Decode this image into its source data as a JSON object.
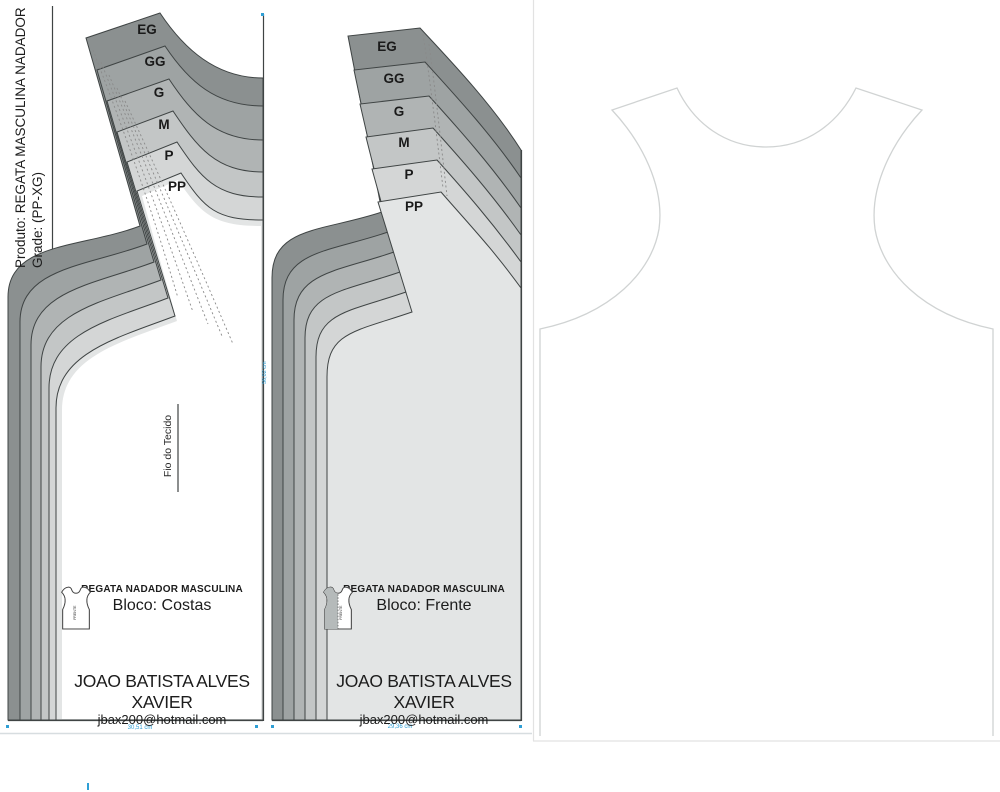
{
  "product_label": {
    "line1": "Produto: REGATA MASCULINA NADADOR",
    "line2": "Grade: (PP-XG)"
  },
  "sizes": [
    "EG",
    "GG",
    "G",
    "M",
    "P",
    "PP"
  ],
  "grain_line_label": "Fio do Tecido",
  "blocks": {
    "costas": {
      "title": "REGATA NADADOR MASCULINA",
      "bloco": "Bloco: Costas",
      "name": "JOAO BATISTA ALVES XAVIER",
      "email": "jbax200@hotmail.com"
    },
    "frente": {
      "title": "REGATA NADADOR MASCULINA",
      "bloco": "Bloco: Frente",
      "name": "JOAO BATISTA ALVES XAVIER",
      "email": "jbax200@hotmail.com"
    }
  },
  "icon_labels": {
    "costa": "COSTA",
    "frente": "FRENTE"
  },
  "measurements": {
    "costas_hem": "30,51 cm",
    "frente_hem": "29,36 cm",
    "frente_side": "56,02 cm"
  },
  "colors": {
    "sizes": [
      "#8b9090",
      "#9ea3a3",
      "#b0b4b4",
      "#c3c6c6",
      "#d4d6d6",
      "#e3e5e5"
    ],
    "outline": "#3f4444",
    "accent_blue": "#2f9fd5",
    "tank_outline": "#d0d3d3",
    "interior_white": "#ffffff"
  }
}
